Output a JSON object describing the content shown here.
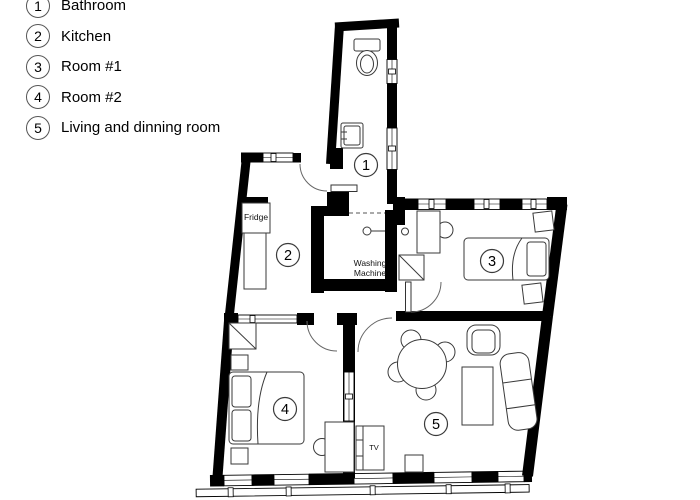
{
  "legend": {
    "items": [
      {
        "number": "1",
        "label": "Bathroom"
      },
      {
        "number": "2",
        "label": "Kitchen"
      },
      {
        "number": "3",
        "label": "Room #1"
      },
      {
        "number": "4",
        "label": "Room #2"
      },
      {
        "number": "5",
        "label": "Living and dinning room"
      }
    ]
  },
  "plan": {
    "room_numbers": [
      "1",
      "2",
      "3",
      "4",
      "5"
    ],
    "labels": {
      "fridge": "Fridge",
      "washing_line1": "Washing",
      "washing_line2": "Machine",
      "tv": "TV"
    },
    "colors": {
      "wall": "#000000",
      "furniture_outline": "#3a3a3a",
      "background": "#ffffff"
    }
  }
}
